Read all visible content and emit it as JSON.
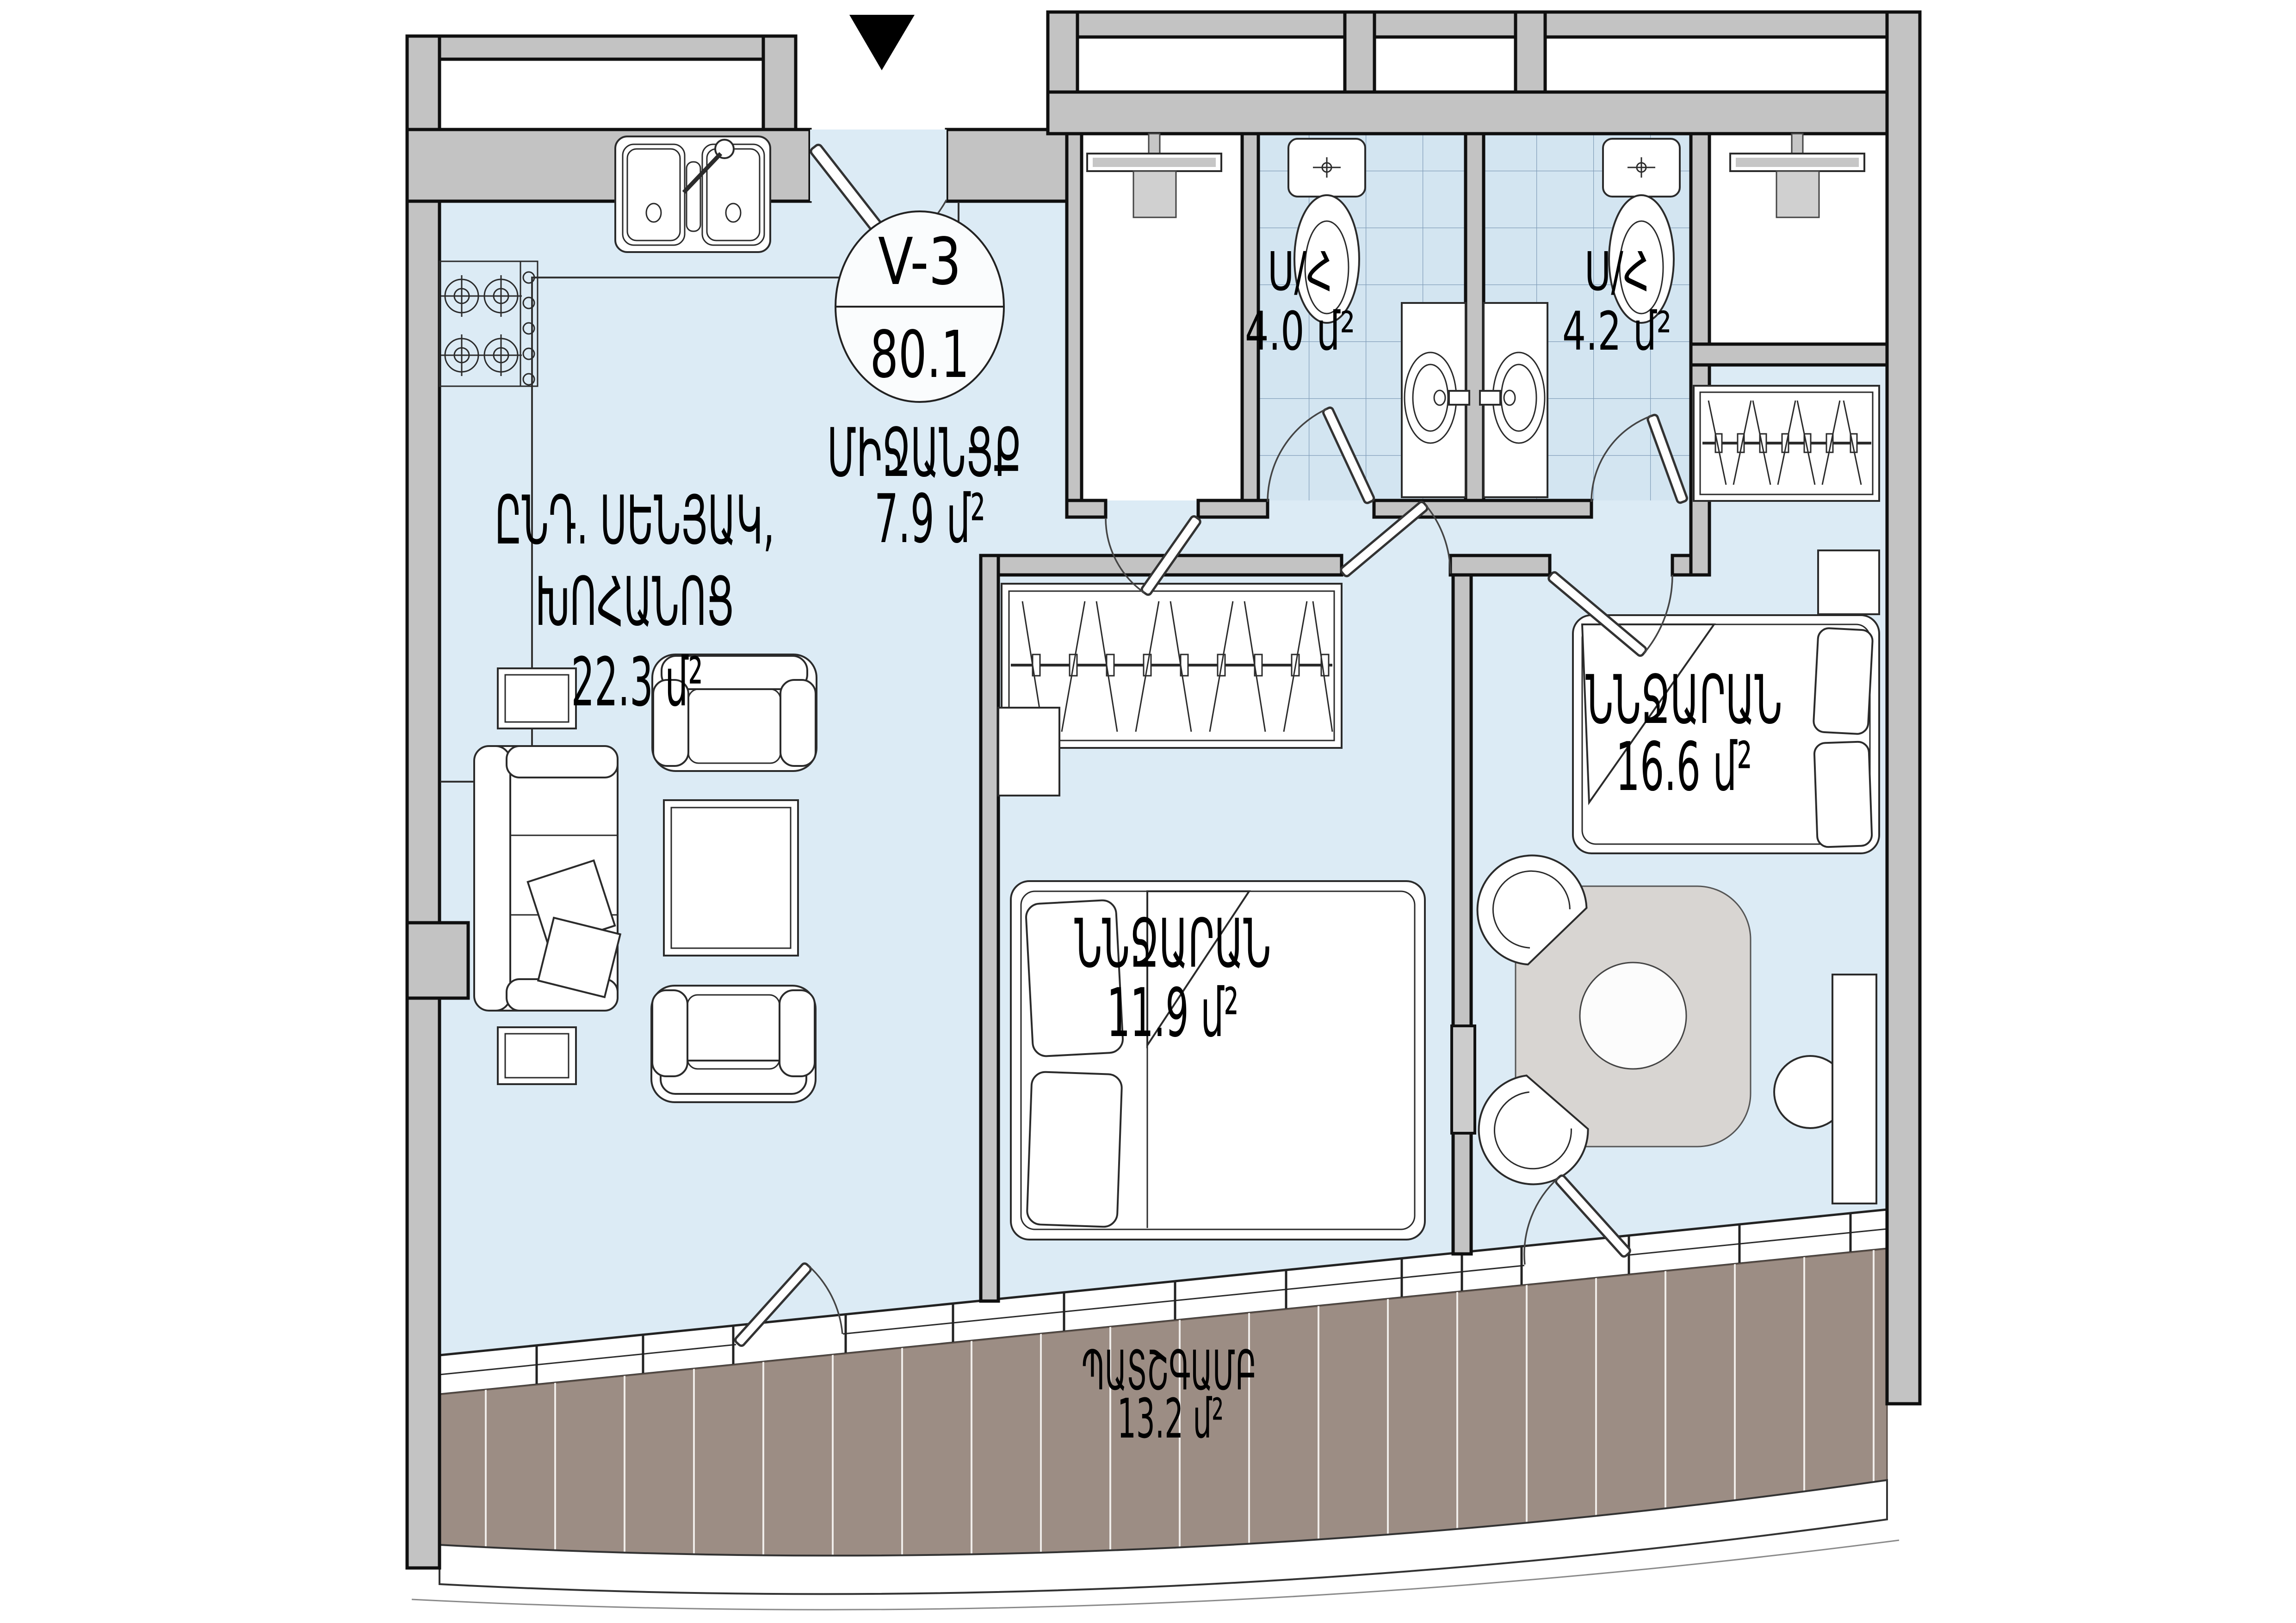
{
  "badge": {
    "unit_code": "V-3",
    "total_area": "80.1"
  },
  "rooms": {
    "hall": {
      "name": "ՄԻՋԱՆՑՔ",
      "area": "7.9 մ²"
    },
    "living_kitchen": {
      "name_line1": "ԸՆԴ. ՍԵՆՅԱԿ,",
      "name_line2": "ԽՈՀԱՆՈՑ",
      "area": "22.3 մ²"
    },
    "bathroom_left": {
      "name": "Ս/Հ",
      "area": "4.0 մ²"
    },
    "bathroom_right": {
      "name": "Ս/Հ",
      "area": "4.2 մ²"
    },
    "bedroom_small": {
      "name": "ՆՆՋԱՐԱՆ",
      "area": "11.9 մ²"
    },
    "bedroom_large": {
      "name": "ՆՆՋԱՐԱՆ",
      "area": "16.6 մ²"
    },
    "balcony": {
      "name": "ՊԱՏՇԳԱՄԲ",
      "area": "13.2 մ²"
    }
  },
  "colors": {
    "floor": "#dcebf5",
    "tile": "#d3e5f1",
    "tile_line": "#6d8cab",
    "wall": "#c3c3c3",
    "wall_outline": "#0f0f0f",
    "deck": "#9c8d84",
    "plank": "#efece9",
    "furniture_outline": "#2b2b2b",
    "table": "#d8d5d2",
    "marker": "#000000"
  }
}
